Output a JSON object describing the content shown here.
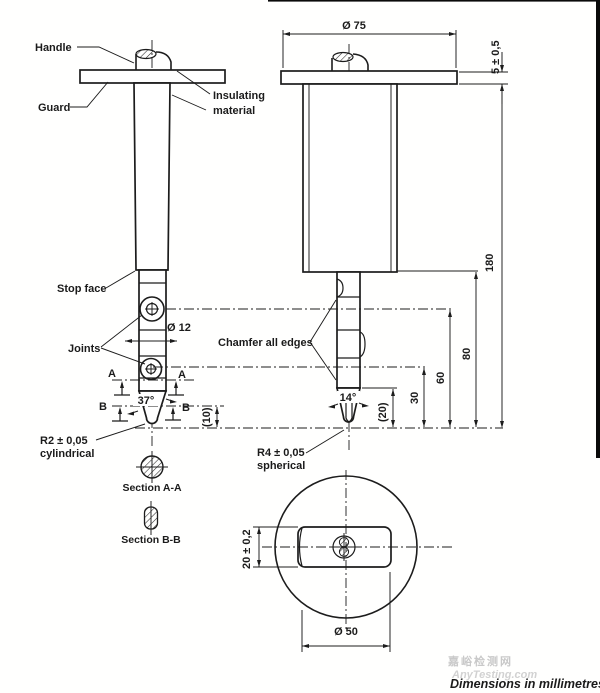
{
  "drawing": {
    "labels": {
      "handle": "Handle",
      "guard": "Guard",
      "insulating_1": "Insulating",
      "insulating_2": "material",
      "stop_face": "Stop face",
      "joints": "Joints",
      "chamfer": "Chamfer all edges",
      "r2_1": "R2 ± 0,05",
      "r2_2": "cylindrical",
      "r4_1": "R4 ± 0,05",
      "r4_2": "spherical",
      "section_aa": "Section A-A",
      "section_bb": "Section B-B"
    },
    "dimensions": {
      "dia75": "Ø 75",
      "thickness5": "5 ± 0,5",
      "len180": "180",
      "len80": "80",
      "len60": "60",
      "len30": "30",
      "len20ref": "(20)",
      "len10ref": "(10)",
      "dia12": "Ø 12",
      "angle37": "37°",
      "angle14": "14°",
      "dia50": "Ø 50",
      "thickness20": "20 ± 0,2"
    },
    "section_markers": {
      "a": "A",
      "b": "B"
    },
    "watermark": {
      "cn": "嘉峪检测网",
      "en": "AnyTesting.com"
    },
    "footer_note": "Dimensions in millimetres",
    "colors": {
      "line": "#1c1c1c",
      "watermark": "#c9c9c9",
      "background": "#ffffff"
    }
  }
}
